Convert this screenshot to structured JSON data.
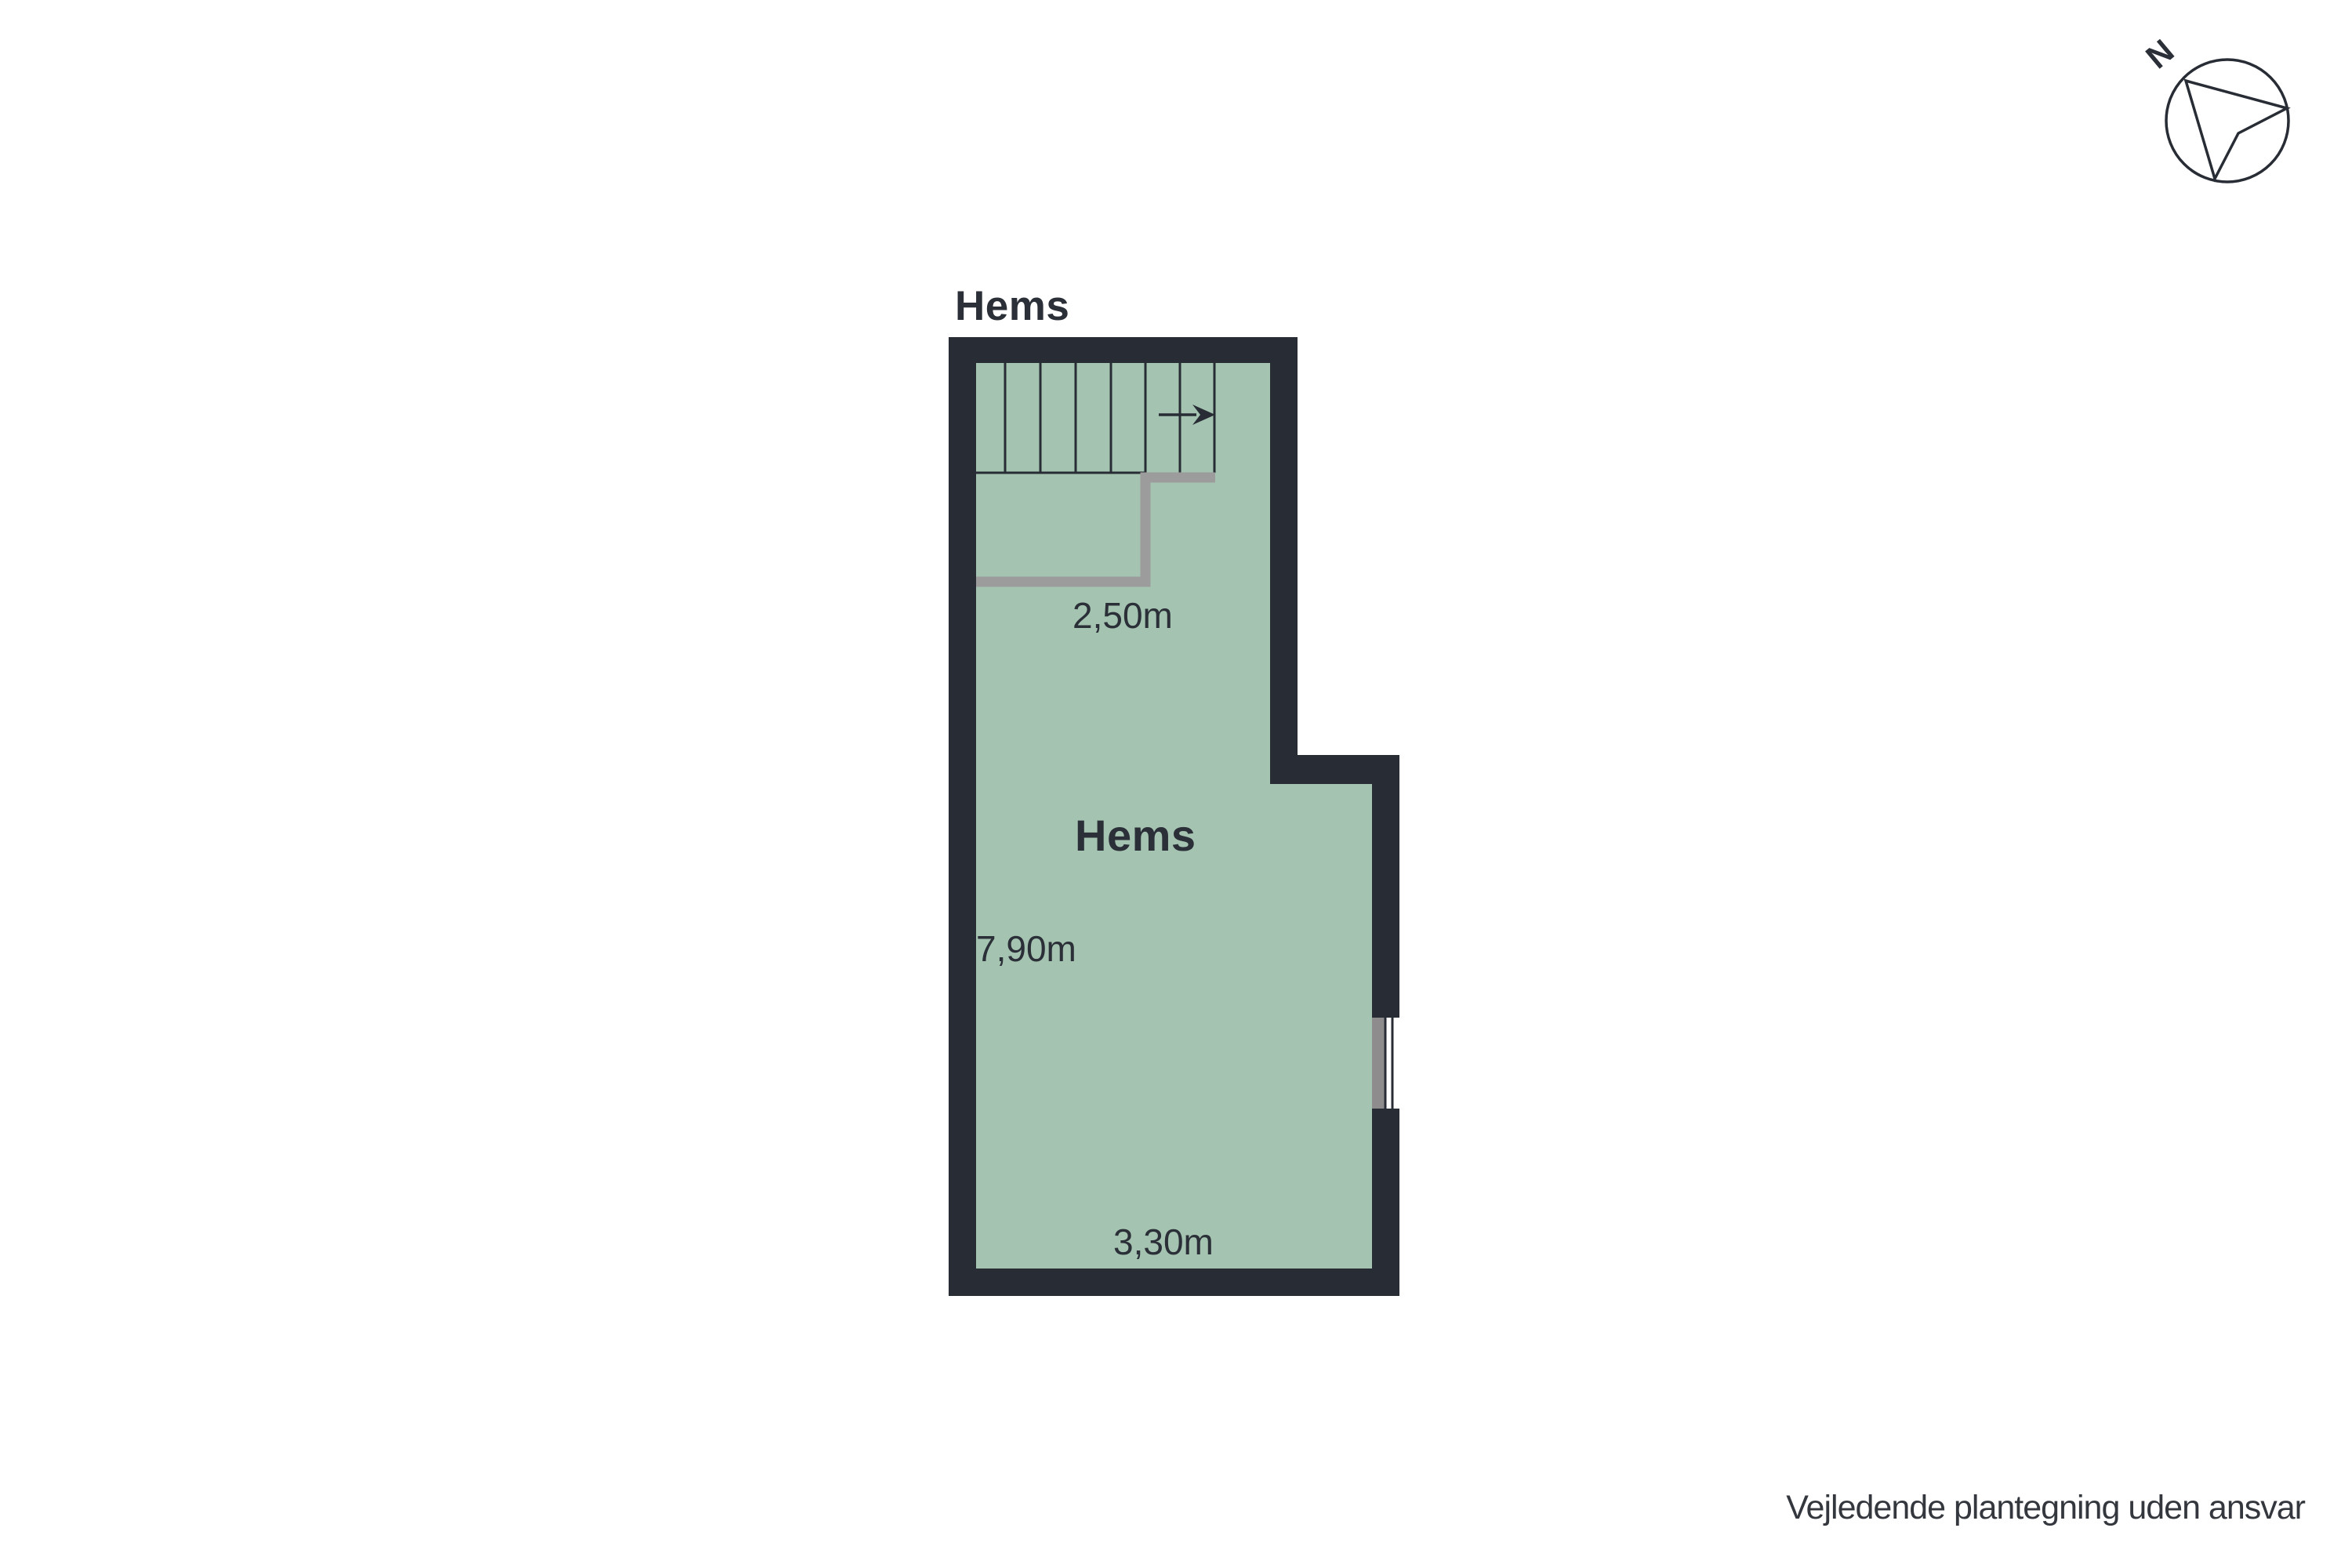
{
  "page": {
    "disclaimer": "Vejledende plantegning uden ansvar"
  },
  "floor_plan": {
    "title": "Hems",
    "room_label": "Hems",
    "dimensions": {
      "width_top": "2,50m",
      "height_left": "7,90m",
      "width_bottom": "3,30m"
    },
    "compass": {
      "label": "N"
    },
    "colors": {
      "bg": "#ffffff",
      "wall": "#282c35",
      "floor": "#a4c3b0",
      "railing": "#9c9c9c",
      "window_gray": "#8e8c8d",
      "window_pane": "#ffffff",
      "text": "#2b2f38",
      "disclaimer": "#34383e"
    }
  }
}
